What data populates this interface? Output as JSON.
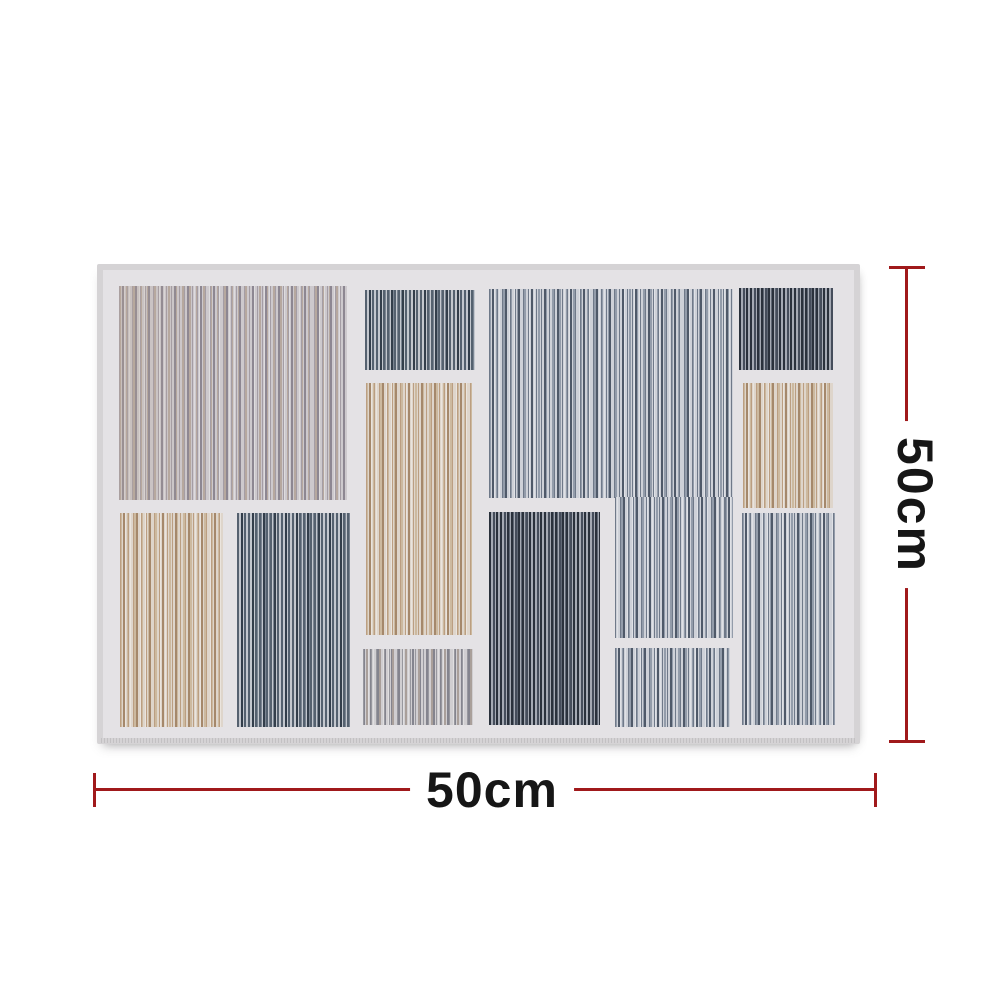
{
  "image_type": "product-photo-with-dimensions",
  "background_color": "#ffffff",
  "dimensions": {
    "line_color": "#a0191b",
    "label_color": "#161616",
    "horizontal": {
      "label": "50cm"
    },
    "vertical": {
      "label": "50cm"
    }
  },
  "rug": {
    "field_color": "#e4e2e5",
    "edge_color": "#d5d3d5",
    "schemes": {
      "mauve": {
        "base": "#cdc9cd",
        "s1": "#a49da5",
        "s2": "#8d8792",
        "s3": "#b6a89f"
      },
      "tan": {
        "base": "#ded5cb",
        "s1": "#bb9e81",
        "s2": "#a5886b",
        "s3": "#ccb99f"
      },
      "slate": {
        "base": "#ced1d8",
        "s1": "#6f7989",
        "s2": "#4f5969",
        "s3": "#939caa"
      },
      "slateDark": {
        "base": "#c3c7ce",
        "s1": "#55616f",
        "s2": "#333e4b",
        "s3": "#7b8592",
        "dense": true
      },
      "charcoal": {
        "base": "#a4a9b3",
        "s1": "#2a313c",
        "s2": "#454d5b",
        "s3": "#5f6774",
        "dense": true
      },
      "silver": {
        "base": "#d0ced1",
        "s1": "#98989f",
        "s2": "#a99f9a",
        "s3": "#84848e"
      }
    },
    "panels": [
      {
        "id": "top-left",
        "scheme": "mauve",
        "x": 16,
        "y": 16,
        "w": 228,
        "h": 214,
        "warm_left": true
      },
      {
        "id": "mid-top",
        "scheme": "slateDark",
        "x": 262,
        "y": 20,
        "w": 110,
        "h": 80
      },
      {
        "id": "mid-tan",
        "scheme": "tan",
        "x": 263,
        "y": 113,
        "w": 106,
        "h": 252
      },
      {
        "id": "mid-bottom",
        "scheme": "silver",
        "x": 260,
        "y": 379,
        "w": 110,
        "h": 76
      },
      {
        "id": "center-main",
        "scheme": "slate",
        "x": 386,
        "y": 19,
        "w": 244,
        "h": 209
      },
      {
        "id": "center-main-lower",
        "scheme": "slate",
        "x": 512,
        "y": 227,
        "w": 118,
        "h": 141,
        "bgShiftX": 126
      },
      {
        "id": "center-dark",
        "scheme": "charcoal",
        "x": 386,
        "y": 242,
        "w": 111,
        "h": 213
      },
      {
        "id": "center-bottom",
        "scheme": "slate",
        "x": 512,
        "y": 378,
        "w": 115,
        "h": 79
      },
      {
        "id": "bottom-left-tan",
        "scheme": "tan",
        "x": 17,
        "y": 243,
        "w": 103,
        "h": 214
      },
      {
        "id": "bottom-left-slate",
        "scheme": "slateDark",
        "x": 134,
        "y": 243,
        "w": 113,
        "h": 214
      },
      {
        "id": "right-top-dark",
        "scheme": "charcoal",
        "x": 636,
        "y": 18,
        "w": 94,
        "h": 82
      },
      {
        "id": "right-tan",
        "scheme": "tan",
        "x": 640,
        "y": 113,
        "w": 90,
        "h": 125
      },
      {
        "id": "right-slate",
        "scheme": "slate",
        "x": 639,
        "y": 243,
        "w": 93,
        "h": 212
      }
    ]
  }
}
